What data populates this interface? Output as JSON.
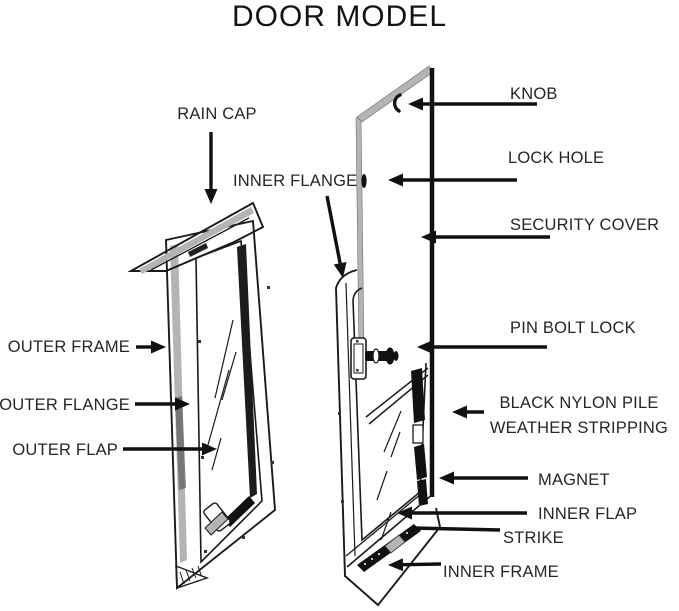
{
  "title": "DOOR MODEL",
  "colors": {
    "line": "#1a1a1a",
    "gray": "#b4b4b4",
    "text": "#262626",
    "arrow": "#111111"
  },
  "labels": [
    {
      "id": "rain-cap",
      "lines": [
        "RAIN CAP"
      ],
      "anchor": "middle",
      "tx": 217,
      "ty": 119,
      "arrow": {
        "x1": 211,
        "y1": 132,
        "x2": 211,
        "y2": 204,
        "head": true
      }
    },
    {
      "id": "inner-flange",
      "lines": [
        "INNER FLANGE"
      ],
      "anchor": "start",
      "tx": 233,
      "ty": 186,
      "arrow": {
        "x1": 327,
        "y1": 196,
        "x2": 343,
        "y2": 278,
        "head": true
      }
    },
    {
      "id": "knob",
      "lines": [
        "KNOB"
      ],
      "anchor": "start",
      "tx": 510,
      "ty": 99,
      "arrow": {
        "x1": 537,
        "y1": 104,
        "x2": 408,
        "y2": 104,
        "head": true
      }
    },
    {
      "id": "lock-hole",
      "lines": [
        "LOCK HOLE"
      ],
      "anchor": "start",
      "tx": 508,
      "ty": 163,
      "arrow": {
        "x1": 517,
        "y1": 180,
        "x2": 388,
        "y2": 180,
        "head": true
      }
    },
    {
      "id": "security-cover",
      "lines": [
        "SECURITY COVER"
      ],
      "anchor": "start",
      "tx": 510,
      "ty": 230,
      "arrow": {
        "x1": 550,
        "y1": 237,
        "x2": 421,
        "y2": 237,
        "head": true
      }
    },
    {
      "id": "pin-bolt-lock",
      "lines": [
        "PIN BOLT LOCK"
      ],
      "anchor": "start",
      "tx": 510,
      "ty": 333,
      "arrow": {
        "x1": 547,
        "y1": 347,
        "x2": 417,
        "y2": 347,
        "head": true
      }
    },
    {
      "id": "weather-stripping",
      "lines": [
        "BLACK NYLON PILE",
        "WEATHER STRIPPING"
      ],
      "anchor": "middle",
      "tx": 579,
      "ty": 408,
      "line_height": 25,
      "arrow": {
        "x1": 484,
        "y1": 412,
        "x2": 452,
        "y2": 412,
        "head": true
      }
    },
    {
      "id": "magnet",
      "lines": [
        "MAGNET"
      ],
      "anchor": "start",
      "tx": 538,
      "ty": 485,
      "arrow": {
        "x1": 528,
        "y1": 478,
        "x2": 439,
        "y2": 478,
        "head": true
      }
    },
    {
      "id": "inner-flap",
      "lines": [
        "INNER FLAP"
      ],
      "anchor": "start",
      "tx": 538,
      "ty": 519,
      "arrow": {
        "x1": 527,
        "y1": 513,
        "x2": 397,
        "y2": 513,
        "head": true
      }
    },
    {
      "id": "strike",
      "lines": [
        "STRIKE"
      ],
      "anchor": "start",
      "tx": 503,
      "ty": 543,
      "arrow": {
        "x1": 500,
        "y1": 530,
        "x2": 413,
        "y2": 528,
        "head": false
      }
    },
    {
      "id": "inner-frame",
      "lines": [
        "INNER FRAME"
      ],
      "anchor": "start",
      "tx": 443,
      "ty": 577,
      "arrow": {
        "x1": 441,
        "y1": 564,
        "x2": 388,
        "y2": 565,
        "head": true
      }
    },
    {
      "id": "outer-frame",
      "lines": [
        "OUTER FRAME"
      ],
      "anchor": "end",
      "tx": 130,
      "ty": 352,
      "arrow": {
        "x1": 136,
        "y1": 347,
        "x2": 166,
        "y2": 347,
        "head": true
      }
    },
    {
      "id": "outer-flange",
      "lines": [
        "OUTER FLANGE"
      ],
      "anchor": "end",
      "tx": 130,
      "ty": 410,
      "arrow": {
        "x1": 135,
        "y1": 404,
        "x2": 190,
        "y2": 404,
        "head": true
      }
    },
    {
      "id": "outer-flap",
      "lines": [
        "OUTER FLAP"
      ],
      "anchor": "end",
      "tx": 118,
      "ty": 455,
      "arrow": {
        "x1": 123,
        "y1": 449,
        "x2": 217,
        "y2": 449,
        "head": true
      }
    }
  ]
}
